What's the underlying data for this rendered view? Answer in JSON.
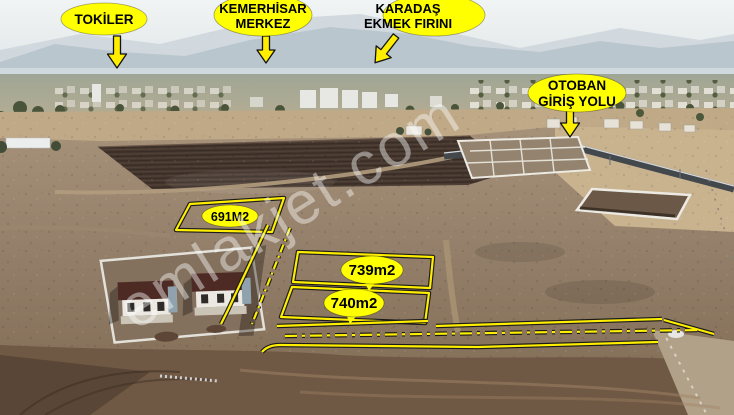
{
  "watermark": {
    "text": "emlakjet.com"
  },
  "location_labels": {
    "tokiler": {
      "text": "TOKİLER"
    },
    "kemerhisar": {
      "line1": "KEMERHİSAR",
      "line2": "MERKEZ"
    },
    "karadas": {
      "line1": "KARADAŞ",
      "line2": "EKMEK FIRINI"
    },
    "otoban": {
      "line1": "OTOBAN",
      "line2": "GİRİŞ YOLU"
    }
  },
  "parcel_labels": {
    "p691": "691M2",
    "p739": "739m2",
    "p740": "740m2"
  },
  "colors": {
    "annotation_yellow": "#ffee00",
    "balloon_fill": "#ffff00",
    "balloon_text": "#000000"
  }
}
